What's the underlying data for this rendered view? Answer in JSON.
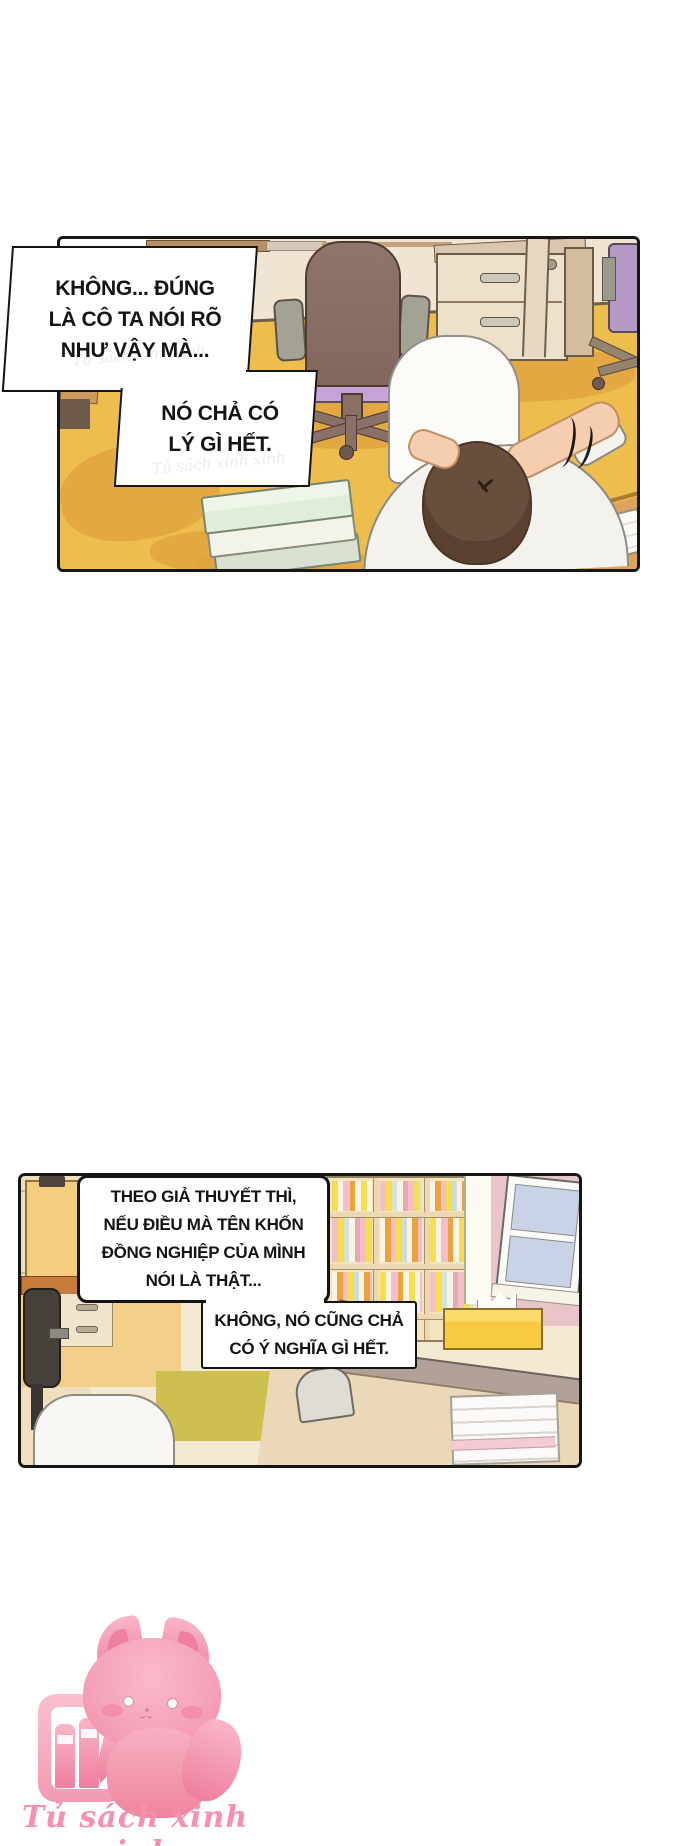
{
  "page": {
    "width": 700,
    "height": 1846,
    "background": "#ffffff"
  },
  "panel1": {
    "bubbles": [
      {
        "lines": [
          "KHÔNG... ĐÚNG",
          "LÀ CÔ TA NÓI RÕ",
          "NHƯ VẬY MÀ..."
        ]
      },
      {
        "lines": [
          "NÓ CHẢ CÓ",
          "LÝ GÌ HẾT."
        ]
      }
    ],
    "watermark": "Tủ sách xinh xinh"
  },
  "panel2": {
    "bubbles": [
      {
        "lines": [
          "THEO GIẢ THUYẾT THÌ,",
          "NẾU ĐIỀU MÀ TÊN KHỐN",
          "ĐỒNG NGHIỆP CỦA MÌNH",
          "NÓI LÀ THẬT..."
        ]
      },
      {
        "lines": [
          "KHÔNG, NÓ CŨNG CHẢ",
          "CÓ Ý NGHĨA GÌ HẾT."
        ]
      }
    ]
  },
  "footer": {
    "brand_text": "Tủ sách xinh xinh"
  },
  "colors": {
    "panel_border": "#161616",
    "wall": "#f2e4d2",
    "floor_yellow": "#edbd4e",
    "floor_shadow": "#e0a43f",
    "chair_mauve": "#8f756b",
    "chair_purple": "#c7a3dc",
    "cabinet_cream": "#eee1ca",
    "hair_brown": "#6a4e3c",
    "skin": "#f5cdaf",
    "shirt": "#f4f2ed",
    "desk_wood": "#dda459",
    "paper_yellow": "#f9e84a",
    "book_mint": "#e0edda",
    "shelf_cream": "#f4e5c0",
    "wall_pink": "#eac4ca",
    "window_glass": "#c9d3e5",
    "tissue_yellow": "#f7ca42",
    "divider_top": "#b2a198",
    "divider_front": "#ead8b8",
    "floor_olive": "#cdc050",
    "mascot_pink": "#f59ab4",
    "brand_pink": "#f590ae"
  }
}
